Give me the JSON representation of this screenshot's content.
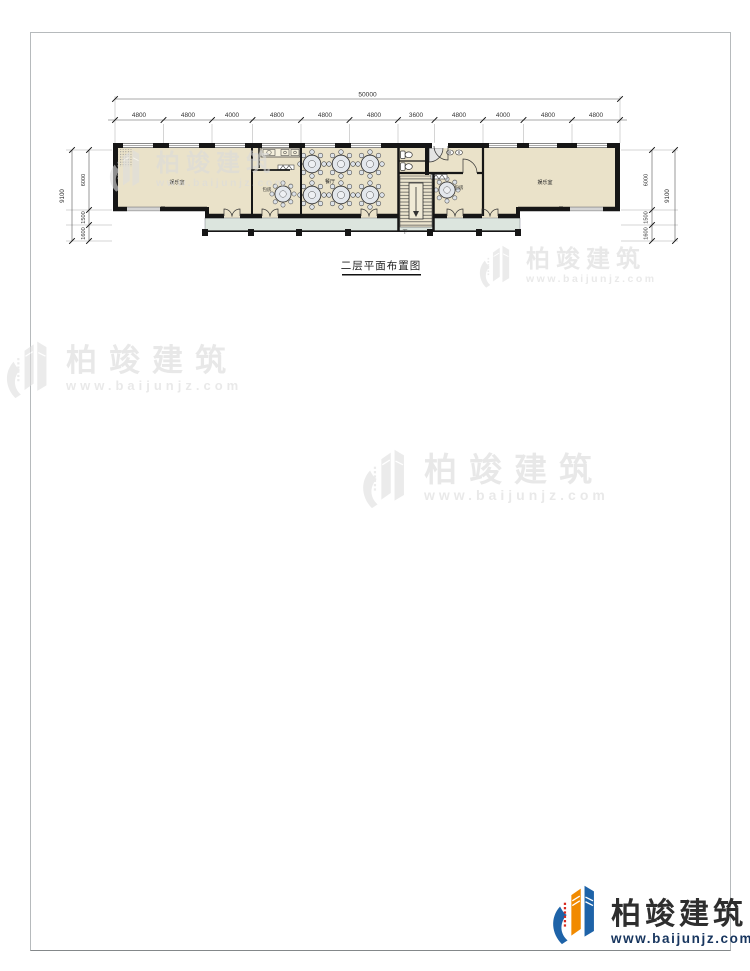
{
  "page": {
    "title": "二层平面布置图"
  },
  "plan": {
    "dims": {
      "total_width": "50000",
      "top_segments": [
        "4800",
        "4800",
        "4000",
        "4800",
        "4800",
        "4800",
        "3600",
        "4800",
        "4000",
        "4800",
        "4800"
      ],
      "total_height": "9100",
      "side_segments": [
        "6000",
        "1500",
        "1600"
      ]
    },
    "rooms": {
      "left_hall": "娱乐室",
      "private_left": "包房",
      "dining": "餐厅",
      "private_right": "包房",
      "right_hall": "娱乐室",
      "stair_down": "下"
    }
  },
  "watermark": {
    "brand": "柏竣建筑",
    "url": "www.baijunjz.com"
  },
  "footer": {
    "brand": "柏竣建筑",
    "url": "www.baijunjz.com"
  },
  "colors": {
    "room_fill": "#eae2c9",
    "balcony_fill": "#dce5de",
    "wall": "#161616",
    "brand_blue": "#1e63a8",
    "brand_orange": "#f18a00",
    "brand_red": "#d8281e"
  }
}
